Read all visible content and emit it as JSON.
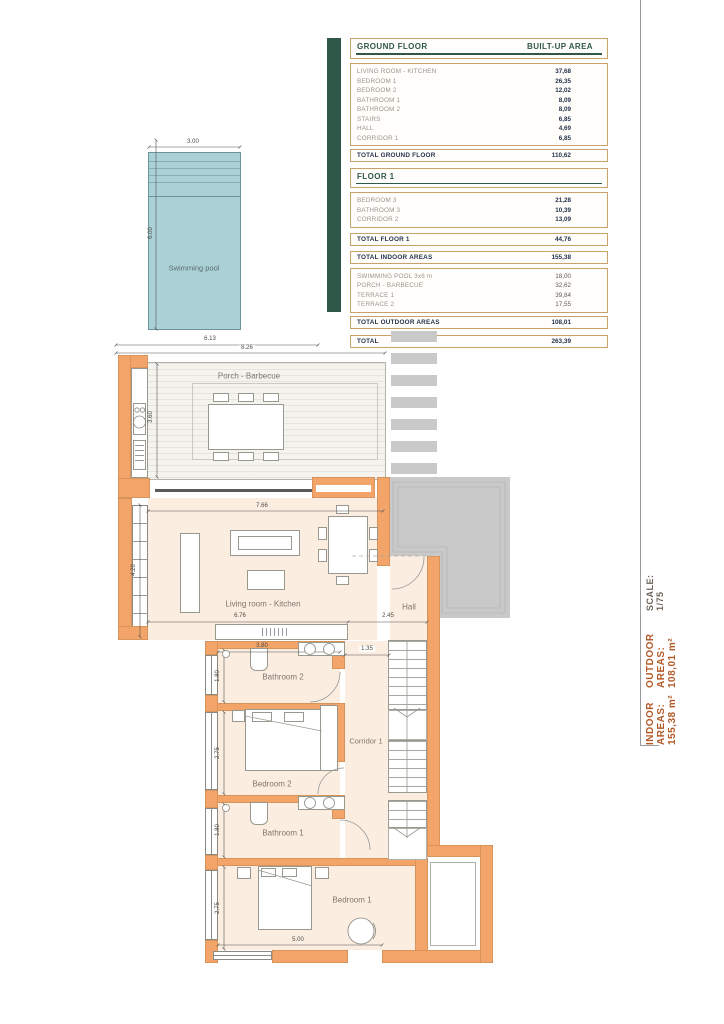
{
  "area_table": {
    "ground": {
      "header": {
        "col1": "GROUND FLOOR",
        "col2": "BUILT-UP AREA"
      },
      "rows": [
        {
          "label": "LIVING ROOM - KITCHEN",
          "value": "37,68"
        },
        {
          "label": "BEDROOM 1",
          "value": "26,35"
        },
        {
          "label": "BEDROOM 2",
          "value": "12,02"
        },
        {
          "label": "BATHROOM 1",
          "value": "8,09"
        },
        {
          "label": "BATHROOM 2",
          "value": "8,09"
        },
        {
          "label": "STAIRS",
          "value": "6,85"
        },
        {
          "label": "HALL",
          "value": "4,69"
        },
        {
          "label": "CORRIDOR 1",
          "value": "6,85"
        }
      ],
      "total": {
        "label": "TOTAL GROUND FLOOR",
        "value": "110,62"
      }
    },
    "floor1": {
      "header": "FLOOR 1",
      "rows": [
        {
          "label": "BEDROOM 3",
          "value": "21,28"
        },
        {
          "label": "BATHROOM 3",
          "value": "10,39"
        },
        {
          "label": "CORRIDOR 2",
          "value": "13,09"
        }
      ],
      "total": {
        "label": "TOTAL FLOOR 1",
        "value": "44,76"
      }
    },
    "indoor_total": {
      "label": "TOTAL INDOOR AREAS",
      "value": "155,38"
    },
    "outdoor": {
      "rows": [
        {
          "label": "SWIMMING POOL 3x6 m",
          "value": "18,00"
        },
        {
          "label": "PORCH - BARBECUE",
          "value": "32,62"
        },
        {
          "label": "TERRACE 1",
          "value": "39,84"
        },
        {
          "label": "TERRACE 2",
          "value": "17,55"
        }
      ],
      "total": {
        "label": "TOTAL OUTDOOR AREAS",
        "value": "108,01"
      }
    },
    "grand_total": {
      "label": "TOTAL",
      "value": "263,39"
    }
  },
  "pool": {
    "label": "Swimming pool",
    "dim_w": "3.00",
    "dim_h": "6.00"
  },
  "plan": {
    "labels": {
      "porch": "Porch - Barbecue",
      "living": "Living room - Kitchen",
      "hall": "Hall",
      "bath2": "Bathroom 2",
      "corridor1": "Corridor 1",
      "bed2": "Bedroom 2",
      "bath1": "Bathroom 1",
      "bed1": "Bedroom 1"
    },
    "dims": {
      "d613": "6.13",
      "d826": "8.26",
      "d360": "3.60",
      "d766": "7.66",
      "d420": "4.20",
      "d676": "6.76",
      "d245": "2.45",
      "d380": "3.80",
      "d135": "1.35",
      "d180a": "1.80",
      "d275a": "2.75",
      "d180b": "1.80",
      "d275b": "2.75",
      "d500": "5.00"
    }
  },
  "sidebar": {
    "indoor": "INDOOR AREAS: 155,38 m²",
    "outdoor": "OUTDOOR AREAS: 108,01 m²",
    "scale": "SCALE: 1/75"
  },
  "colors": {
    "wall_orange": "#F2A469",
    "room_fill": "#FBEDE0",
    "pool_teal": "#AAD2D6",
    "table_green": "#2F5849",
    "table_border_tan": "#C8A269",
    "sidebar_orange": "#b45a28",
    "terrace_gray": "#c9c9c9"
  }
}
